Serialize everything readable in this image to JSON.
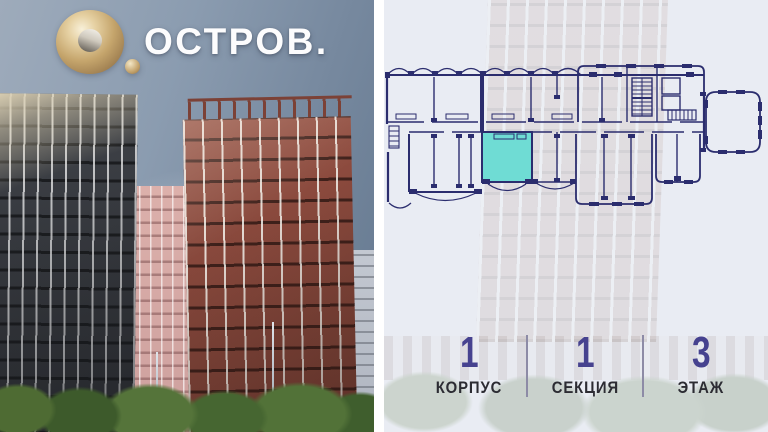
{
  "brand": {
    "wordmark": "ОСТРОВ.",
    "mark_icon": "gold-ring-o-icon",
    "gold_color": "#c9a878"
  },
  "plan": {
    "highlight_color": "#6fdcd4",
    "line_color": "#2b2d6e",
    "highlighted_unit": "selected-apartment"
  },
  "info": {
    "items": [
      {
        "value": "1",
        "label": "КОРПУС"
      },
      {
        "value": "1",
        "label": "СЕКЦИЯ"
      },
      {
        "value": "3",
        "label": "ЭТАЖ"
      }
    ],
    "number_color": "#46428f",
    "label_color": "#2c2c33"
  },
  "colors": {
    "right_panel_bg": "#e9ecf3",
    "sky": "#8b9cb0",
    "dark_tower": "#33363c",
    "red_tower": "#8a4a3e",
    "pink_tower": "#d8aca8",
    "divider": "#8d8ba6"
  }
}
